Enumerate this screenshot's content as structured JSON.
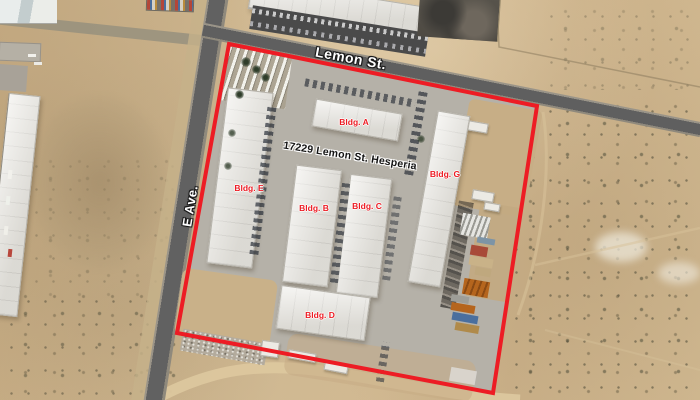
{
  "map": {
    "type": "satellite-aerial-parcel-view",
    "street_labels": [
      {
        "name": "Lemon St."
      },
      {
        "name": "E Ave."
      }
    ],
    "address_label": "17229 Lemon St. Hesperia",
    "building_labels": [
      {
        "label": "Bldg. A"
      },
      {
        "label": "Bldg. E"
      },
      {
        "label": "Bldg. B"
      },
      {
        "label": "Bldg. C"
      },
      {
        "label": "Bldg. G"
      },
      {
        "label": "Bldg. D"
      }
    ],
    "colors": {
      "parcel_boundary": "#ed1c24",
      "building_label": "#ed1c24",
      "street_label_text": "#ffffff",
      "address_text": "#141414"
    }
  }
}
